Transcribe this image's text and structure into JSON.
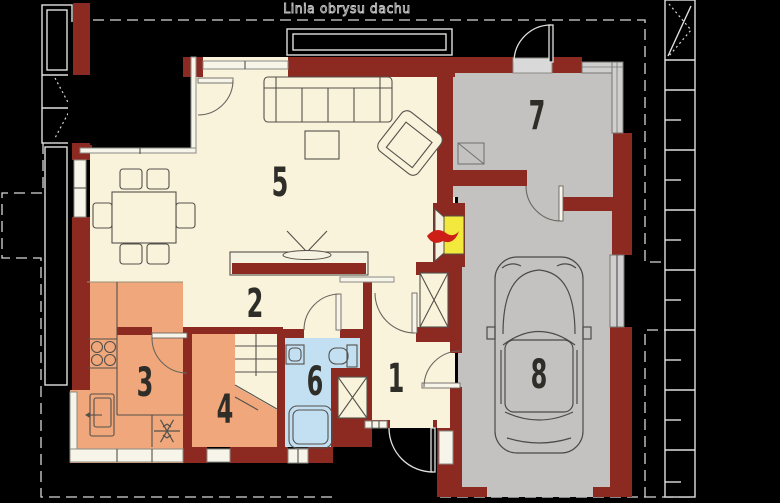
{
  "labels": {
    "roof_outline_line": "Linia obrysu dachu"
  },
  "room_numbers": {
    "hall": "1",
    "corridor": "2",
    "kitchen": "3",
    "storage": "4",
    "living_room": "5",
    "bathroom": "6",
    "utility_room": "7",
    "garage": "8"
  },
  "colors": {
    "wall": "#8c2a21",
    "floor_main": "#faf3dc",
    "floor_warm": "#efa77b",
    "floor_bath": "#c3e0f3",
    "floor_garage": "#c3c2c0",
    "fireplace_yellow": "#f3e93c",
    "flame_red": "#cc2017",
    "line_outline": "#e0e0de",
    "line_furniture": "#54504a"
  }
}
